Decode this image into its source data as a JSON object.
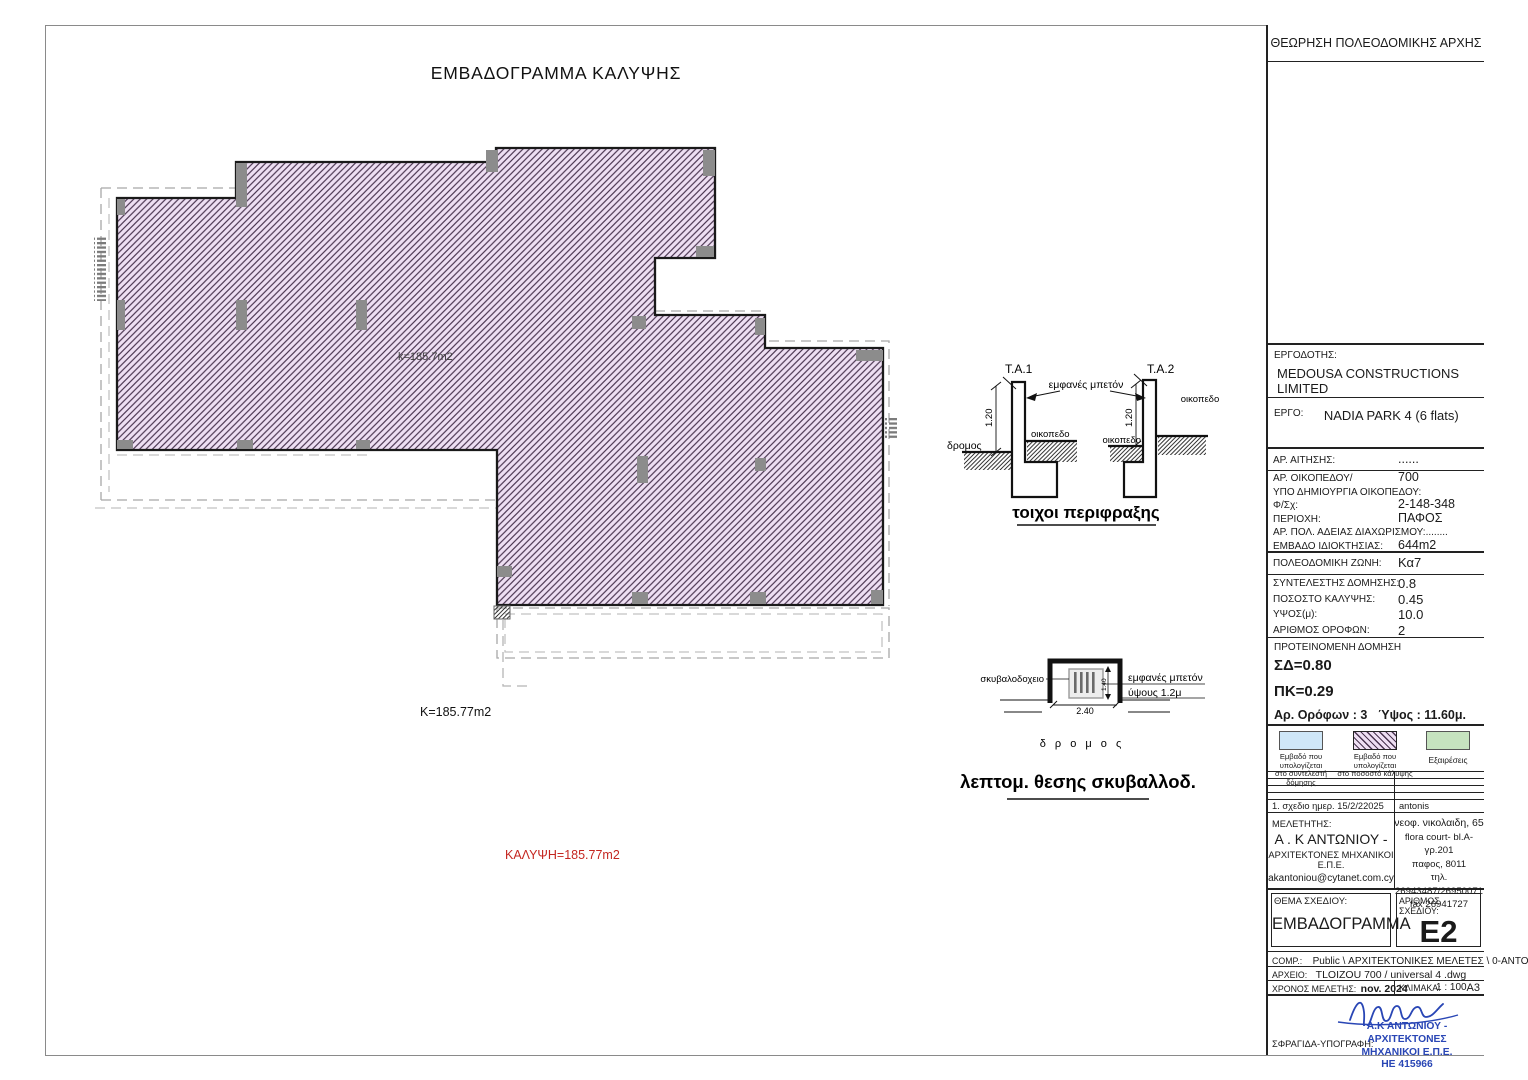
{
  "page": {
    "main_title": "ΕΜΒΑΔΟΓΡΑΜΜΑ ΚΑΛΥΨΗΣ"
  },
  "colors": {
    "hatch_fill": "#eedff3",
    "hatch_line": "#4a3550",
    "coverage_text": "#c42620",
    "stamp_blue": "#2946b5"
  },
  "drawing": {
    "inner_area": "k=185.7m2",
    "area": "K=185.77m2",
    "coverage": "ΚΑΛΥΨΗ=185.77m2"
  },
  "wall_detail": {
    "ta1": "Τ.Α.1",
    "ta2": "Τ.Α.2",
    "concrete": "εμφανές μπετόν",
    "road": "δρομος",
    "plot_a": "οικοπεδο",
    "plot_b": "οικοπεδο",
    "plot_c": "οικοπεδο",
    "dim_a": "1.20",
    "dim_b": "1.20",
    "title": "τοιχοι περιφραξης"
  },
  "bin_detail": {
    "label": "σκυβαλοδοχειο",
    "concrete1": "εμφανές μπετόν",
    "concrete2": "ύψους 1.2μ",
    "dim_w": "2.40",
    "dim_h": "1.40",
    "road": "δ ρ ο μ ο ς",
    "title": "λεπτομ. θεσης σκυβαλλοδ."
  },
  "title_block": {
    "approval": "ΘΕΩΡΗΣΗ ΠΟΛΕΟΔΟΜΙΚΗΣ ΑΡΧΗΣ",
    "client_label": "ΕΡΓΟΔΟΤΗΣ:",
    "client": "MEDOUSA CONSTRUCTIONS LIMITED",
    "project_label": "ΕΡΓΟ:",
    "project": "NADIA PARK 4  (6 flats)",
    "app_label": "ΑΡ. ΑΙΤΗΣΗΣ:",
    "app_value": "......",
    "fields": [
      {
        "label": "ΑΡ. ΟΙΚΟΠΕΔΟΥ/",
        "value": "700"
      },
      {
        "label": "ΥΠΟ ΔΗΜΙΟΥΡΓΙΑ ΟΙΚΟΠΕΔΟΥ:",
        "value": ""
      },
      {
        "label": "Φ/Σχ:",
        "value": "2-148-348"
      },
      {
        "label": "ΠΕΡΙΟΧΗ:",
        "value": "ΠΑΦΟΣ"
      },
      {
        "label": "ΑΡ. ΠΟΛ. ΑΔΕΙΑΣ ΔΙΑΧΩΡΙΣΜΟΥ:........",
        "value": ""
      },
      {
        "label": "ΕΜΒΑΔΟ ΙΔΙΟΚΤΗΣΙΑΣ:",
        "value": "644m2"
      }
    ],
    "zone_label": "ΠΟΛΕΟΔΟΜΙΚΗ ΖΩΝΗ:",
    "zone_value": "Κα7",
    "factors": [
      {
        "label": "ΣΥΝΤΕΛΕΣΤΗΣ ΔΟΜΗΣΗΣ:",
        "value": "0.8"
      },
      {
        "label": "ΠΟΣΟΣΤΟ ΚΑΛΥΨΗΣ:",
        "value": "0.45"
      },
      {
        "label": "ΥΨΟΣ(μ):",
        "value": "10.0"
      },
      {
        "label": "ΑΡΙΘΜΟΣ ΟΡΟΦΩΝ:",
        "value": "2"
      }
    ],
    "proposed": {
      "header": "ΠΡΟΤΕΙΝΟΜΕΝΗ ΔΟΜΗΣΗ",
      "sd": "ΣΔ=0.80",
      "pk": "ΠΚ=0.29",
      "floors": "Αρ. Ορόφων :  3",
      "height": "Ύψος :  11.60μ."
    },
    "legend": [
      {
        "color": "#cfe7f8",
        "l1": "Εμβαδό που υπολογίζεται",
        "l2": "στο συντελεστή δόμησης"
      },
      {
        "color": "#eedff3",
        "l1": "Εμβαδό που υπολογίζεται",
        "l2": "στο ποσοστό κάλυψης"
      },
      {
        "color": "#c6e3bf",
        "l1": "Εξαιρέσεις",
        "l2": ""
      }
    ],
    "revision": {
      "left": "1. σχεδιο  ημερ.   15/2/22025",
      "right": "antonis"
    },
    "designer": {
      "label": "ΜΕΛΕΤΗΤΗΣ:",
      "name": "Α . Κ ΑΝΤΩΝΙΟΥ -",
      "firm": "ΑΡΧΙΤΕΚΤΟΝΕΣ ΜΗΧΑΝΙΚΟΙ Ε.Π.Ε.",
      "email": "akantoniou@cytanet.com.cy",
      "address": [
        "νεοφ. νικολαιδη, 65",
        "flora court- bl.A- γρ.201",
        "παφος, 8011",
        "τηλ. 26943487/26950071",
        "fax  26941727"
      ]
    },
    "subject_label": "ΘΕΜΑ ΣΧΕΔΙΟΥ:",
    "subject_value": "ΕΜΒΑΔΟΓΡΑΜΜΑ",
    "number_label": "ΑΡΙΘΜΟΣ ΣΧΕΔΙΟΥ:",
    "number_value": "E2",
    "comp_label": "COMP.:",
    "comp_value": "Public \\ ΑΡΧΙΤΕΚΤΟΝΙΚΕΣ ΜΕΛΕΤΕΣ \\ 0-ANTONIS",
    "file_label": "ΑΡΧΕΙΟ:",
    "file_value": "TLOIZOU 700  / universal 4 .dwg",
    "time_label": "ΧΡΟΝΟΣ ΜΕΛΕΤΗΣ:",
    "time_value": "nov.  2024",
    "scale_label": "ΚΛΙΜΑΚΑ:",
    "scale_value": "1 : 100",
    "paper": "A3",
    "stamp_label": "ΣΦΡΑΓΙΔΑ-ΥΠΟΓΡΑΦΗ:",
    "stamp": {
      "l1": "Α.Κ ΑΝΤΩΝΙΟΥ - ΑΡΧΙΤΕΚΤΟΝΕΣ",
      "l2": "ΜΗΧΑΝΙΚΟΙ Ε.Π.Ε.",
      "l3": "ΗΕ 415966"
    }
  }
}
